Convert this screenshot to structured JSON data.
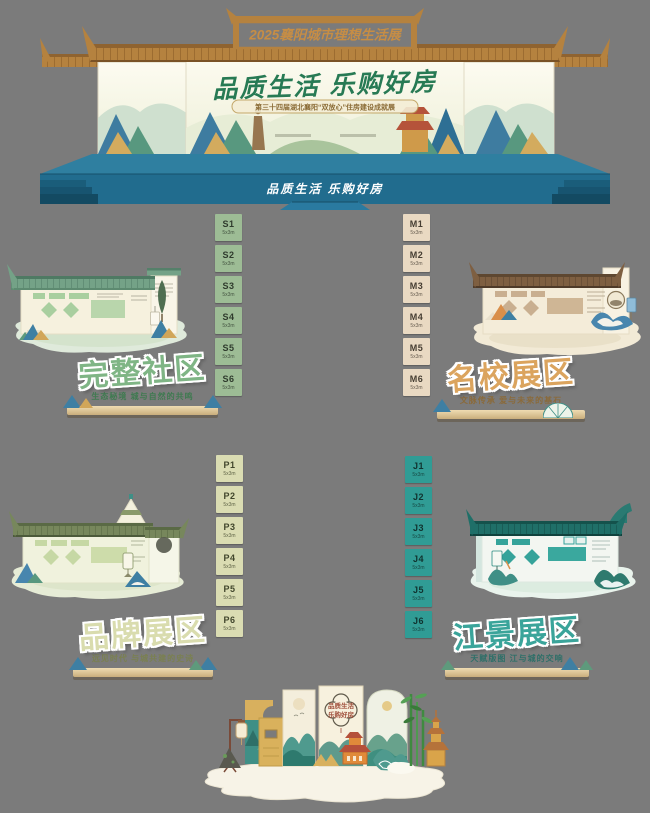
{
  "page": {
    "background_color": "#7b7b7b"
  },
  "stage": {
    "top_banner": "2025襄阳城市理想生活展",
    "main_title": "品质生活  乐购好房",
    "subtitle": "第三十四届湖北襄阳“双放心”住房建设成就展",
    "front_slogan": "品质生活 乐购好房",
    "stage_color": "#216c8e",
    "roof_color": "#b5823f",
    "title_color": "#277a54"
  },
  "zones": {
    "complete_community": {
      "title": "完整社区",
      "tagline": "生态秘境 城与自然的共鸣",
      "accent": "#7fb585"
    },
    "famous_school": {
      "title": "名校展区",
      "tagline": "文脉传承 爱与未来的基石",
      "accent": "#dba45e"
    },
    "brand": {
      "title": "品牌展区",
      "tagline": "远见时代 与城共建的史诗",
      "accent": "#d9dcae"
    },
    "river_view": {
      "title": "江景展区",
      "tagline": "天赋版图 江与城的交响",
      "accent": "#3aa49a"
    }
  },
  "stalls": {
    "s": {
      "cells": [
        {
          "id": "S1",
          "size": "5x3m"
        },
        {
          "id": "S2",
          "size": "5x3m"
        },
        {
          "id": "S3",
          "size": "5x3m"
        },
        {
          "id": "S4",
          "size": "5x3m"
        },
        {
          "id": "S5",
          "size": "5x3m"
        },
        {
          "id": "S6",
          "size": "5x3m"
        }
      ]
    },
    "m": {
      "cells": [
        {
          "id": "M1",
          "size": "5x3m"
        },
        {
          "id": "M2",
          "size": "5x3m"
        },
        {
          "id": "M3",
          "size": "5x3m"
        },
        {
          "id": "M4",
          "size": "5x3m"
        },
        {
          "id": "M5",
          "size": "5x3m"
        },
        {
          "id": "M6",
          "size": "5x3m"
        }
      ]
    },
    "p": {
      "cells": [
        {
          "id": "P1",
          "size": "5x3m"
        },
        {
          "id": "P2",
          "size": "5x3m"
        },
        {
          "id": "P3",
          "size": "5x3m"
        },
        {
          "id": "P4",
          "size": "5x3m"
        },
        {
          "id": "P5",
          "size": "5x3m"
        },
        {
          "id": "P6",
          "size": "5x3m"
        }
      ]
    },
    "j": {
      "cells": [
        {
          "id": "J1",
          "size": "5x3m"
        },
        {
          "id": "J2",
          "size": "5x3m"
        },
        {
          "id": "J3",
          "size": "5x3m"
        },
        {
          "id": "J4",
          "size": "5x3m"
        },
        {
          "id": "J5",
          "size": "5x3m"
        },
        {
          "id": "J6",
          "size": "5x3m"
        }
      ]
    }
  },
  "centerpiece": {
    "slogan_line1": "品质生活",
    "slogan_line2": "乐购好房"
  }
}
